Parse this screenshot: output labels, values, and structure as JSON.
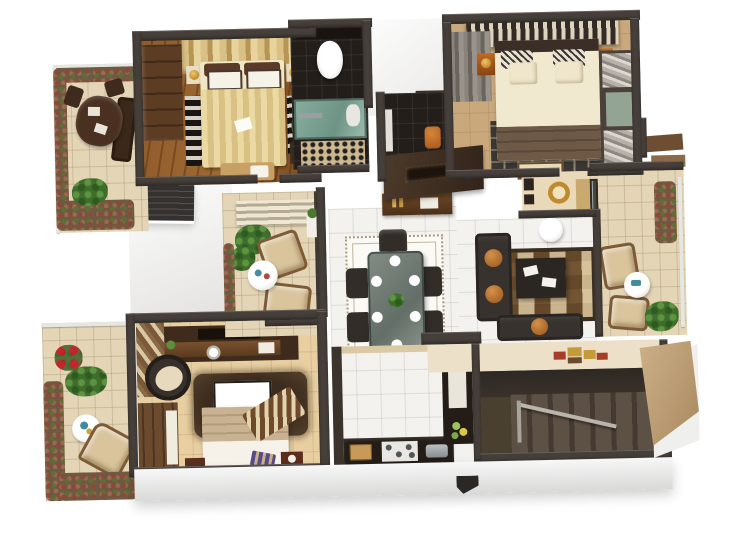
{
  "scene": {
    "title": "3-bedroom apartment 3D floor plan render",
    "view": "top-down cutaway 3D render on white background",
    "visible_text": [],
    "palette": {
      "background": "#ffffff",
      "wall_dark": "#463f3a",
      "wood_floor": "#8a5526",
      "white_tile": "#f3f2ef",
      "beige_tile": "#e3d5b6",
      "tan_floor": "#c9a87c",
      "dark_bath_tile": "#241e1b",
      "kitchen_counter": "#241c16",
      "sofa_charcoal": "#37322e",
      "accent_orange": "#b9722f",
      "gold_bedding": "#e0cb92",
      "brown_blanket": "#6e5846",
      "stair_carpet": "#3a322b",
      "glass_green": "#7ca393",
      "foliage_green": "#4a7030",
      "foliage_maroon": "#7a4a3a",
      "cream_foyer": "#ece0c8",
      "medallion_gold": "#c49a3a",
      "medallion_red": "#a83c28"
    },
    "rooms": [
      {
        "id": "upper-terrace",
        "label": "Upper terrace with outdoor dining",
        "floor": "beige tile",
        "furniture": [
          "dark wood dining table",
          "three chairs",
          "high-back bench",
          "planter hedges",
          "palm plant"
        ]
      },
      {
        "id": "bedroom-1",
        "label": "Bedroom with gold bedding",
        "floor": "wood plank",
        "furniture": [
          "double bed with gold patterned duvet",
          "white pillows",
          "wardrobe",
          "two nightstands with gold lamps",
          "foot bench with pillow",
          "black-white rug",
          "flower vase"
        ]
      },
      {
        "id": "bathroom-1",
        "label": "Bathroom with glass shower",
        "floor": "dark tile",
        "furniture": [
          "toilet",
          "vanity",
          "green glass shower",
          "pebble bath mat"
        ]
      },
      {
        "id": "bathroom-2",
        "label": "Dark tiled bathroom passage",
        "floor": "dark tile",
        "furniture": [
          "orange stool",
          "shelf"
        ]
      },
      {
        "id": "master-bedroom",
        "label": "Master bedroom",
        "floor": "tan",
        "furniture": [
          "double bed with cream sheets and brown blanket",
          "printed pillows",
          "slatted canopy headboard",
          "grey closet",
          "mirror-striped sliding wardrobe",
          "two orange nightstands with lamps",
          "dark patterned rug",
          "door mat"
        ]
      },
      {
        "id": "dressing-nook",
        "label": "Dressing nook",
        "floor": "beige",
        "furniture": [
          "gold drum mirror",
          "wall frames",
          "console"
        ]
      },
      {
        "id": "master-balcony",
        "label": "Right sit-out balcony",
        "floor": "beige tile",
        "furniture": [
          "two cushioned chairs",
          "round side table",
          "hanging planters",
          "potted plant",
          "glass sliding door",
          "awning ledges"
        ]
      },
      {
        "id": "living-room",
        "label": "Living room",
        "floor": "white tile",
        "furniture": [
          "charcoal sofa with orange round cushions",
          "second sofa",
          "patchwork brown rug",
          "dark coffee table",
          "round side table"
        ]
      },
      {
        "id": "dining-room",
        "label": "Dining room",
        "floor": "white tile",
        "furniture": [
          "glass-top six seater table",
          "six dark chairs",
          "white plates",
          "green centerpiece",
          "bordered area rug",
          "sideboard",
          "media wall unit"
        ]
      },
      {
        "id": "kitchen",
        "label": "Kitchen",
        "floor": "white tile",
        "furniture": [
          "L-shaped dark counter",
          "four-burner hob",
          "cutting board",
          "cookware",
          "tall fridge cabinet",
          "green decor jars"
        ]
      },
      {
        "id": "bedroom-2",
        "label": "Lower bedroom",
        "floor": "beige tile",
        "furniture": [
          "bed with tan blanket and striped throw",
          "TV on shaggy brown rug",
          "media console wall",
          "papasan chair",
          "striped curtain",
          "wardrobe",
          "two small nightstands",
          "striped cushion"
        ]
      },
      {
        "id": "garden-terrace",
        "label": "Garden terrace",
        "floor": "beige tile",
        "furniture": [
          "beige armchair",
          "round white table",
          "red flowering shrub",
          "palm",
          "planter hedges",
          "glass railing"
        ]
      },
      {
        "id": "sitout-balcony",
        "label": "Mid-left sit-out balcony",
        "floor": "beige tile",
        "furniture": [
          "two beige lounge chairs",
          "round white table",
          "green plants",
          "hanging vine",
          "slatted railing",
          "wall planter"
        ]
      },
      {
        "id": "entry-foyer",
        "label": "Entry foyer",
        "floor": "cream",
        "furniture": [
          "medallion floor inlay"
        ]
      },
      {
        "id": "staircase",
        "label": "Staircase",
        "floor": "brown carpet",
        "furniture": [
          "two stair flights",
          "metal railing",
          "tan roof panel"
        ]
      }
    ]
  }
}
